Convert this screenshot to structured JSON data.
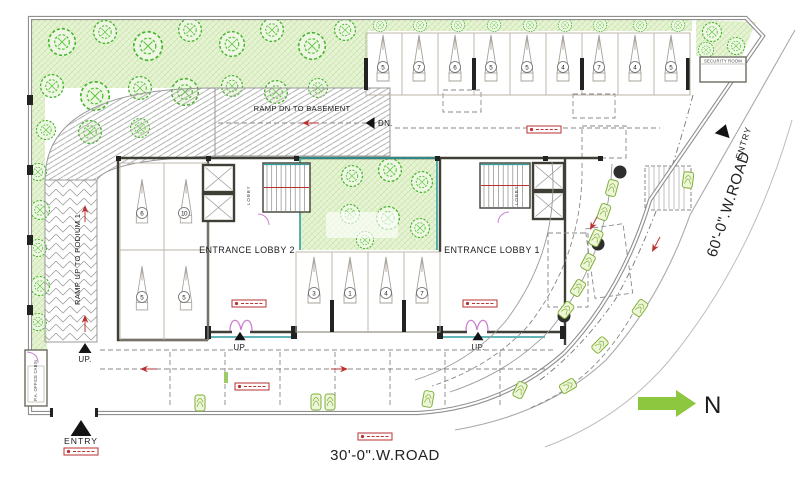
{
  "drawing": {
    "labels": {
      "ramp_dn_basement": "RAMP DN TO BASEMENT",
      "dn": "DN.",
      "ramp_up_podium": "RAMP UP TO PODIUM 1",
      "up": "UP.",
      "entrance_lobby_2": "ENTRANCE LOBBY 2",
      "entrance_lobby_1": "ENTRANCE LOBBY 1",
      "lobby": "LOBBY",
      "entry": "ENTRY",
      "road_30": "30'-0\".W.ROAD",
      "road_60": "60'-0\".W.ROAD",
      "north": "N",
      "office_cabin": "P.A. OFFICE CABIN",
      "security_room": "SECURITY ROOM"
    },
    "parking": {
      "top_row": [
        "5",
        "7",
        "6",
        "5",
        "5",
        "4",
        "7",
        "4",
        "5"
      ],
      "middle_row": [
        "3",
        "1",
        "4",
        "7"
      ],
      "left_block": [
        "6",
        "10",
        "5",
        "5"
      ]
    },
    "colors": {
      "landscape_fill": "#e6f3d5",
      "landscape_line": "#bfe09a",
      "tree_green": "#43b42c",
      "wall_dark": "#3f3f36",
      "boundary_gray": "#8f8f8f",
      "annotation_red": "#b83232",
      "door_pink": "#cc7fd0",
      "glazing_teal": "#2f9e9e",
      "north_arrow_green": "#8dc63f"
    }
  }
}
